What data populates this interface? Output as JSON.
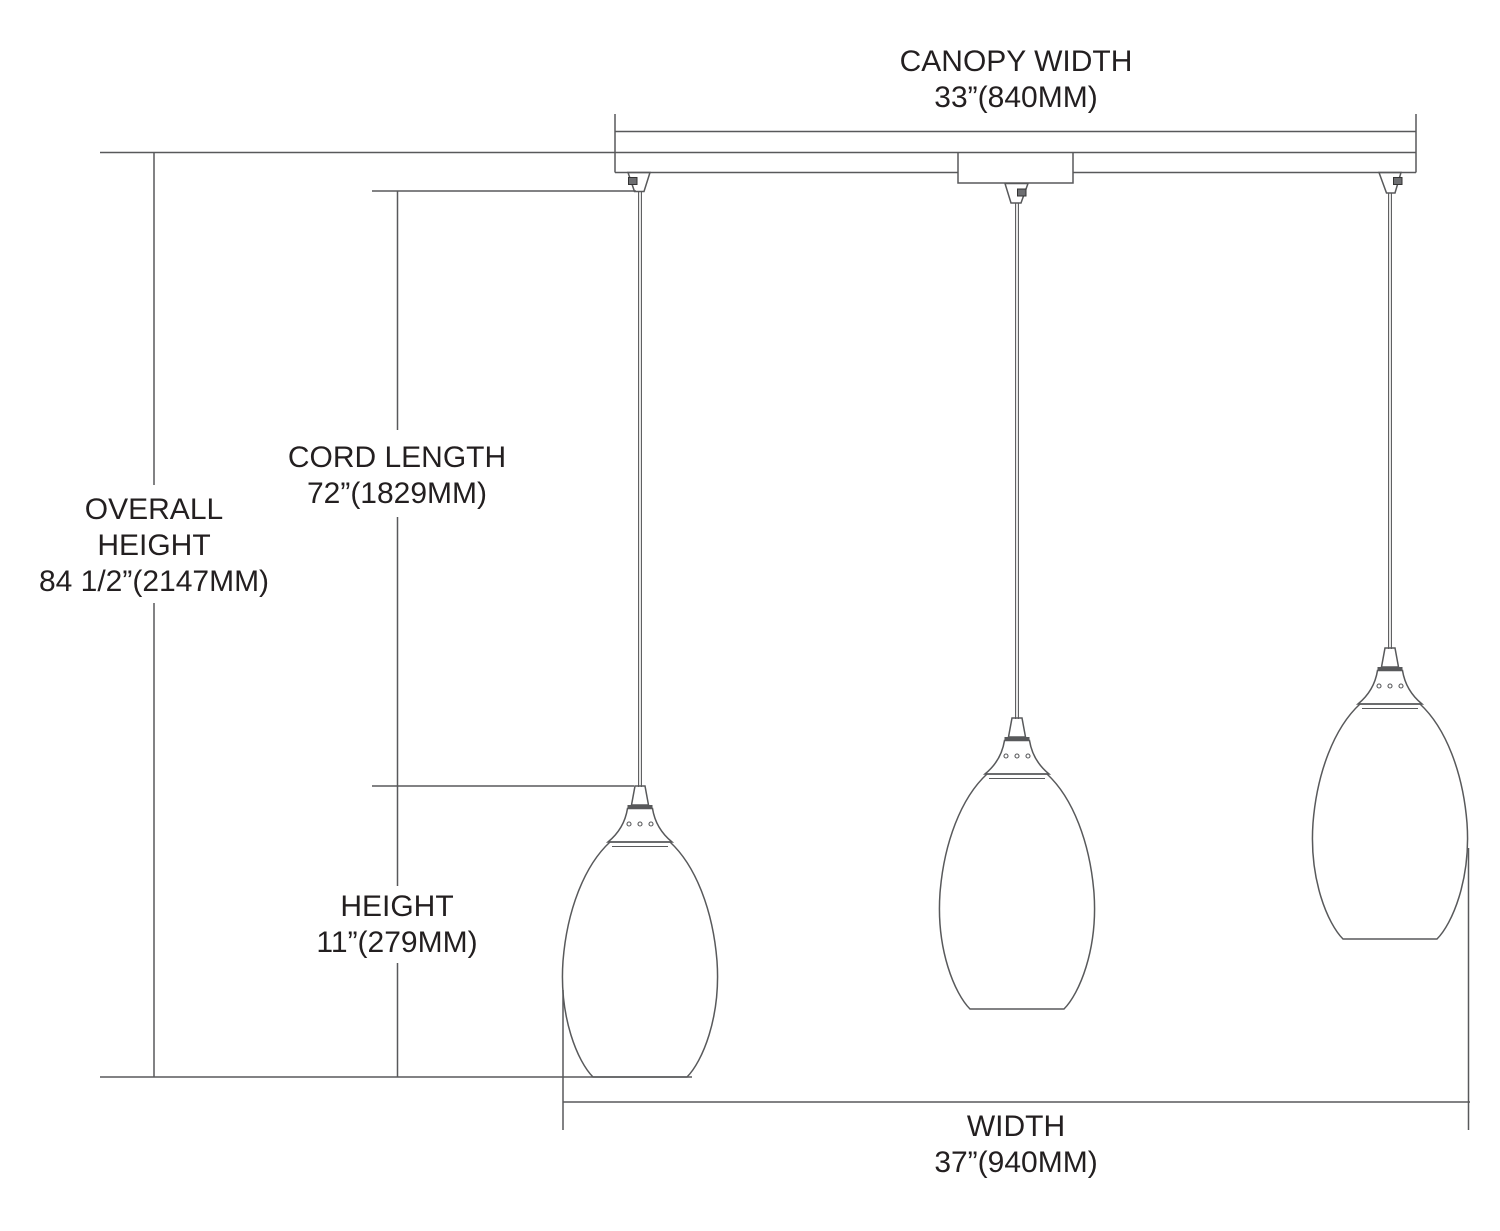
{
  "drawing": {
    "colors": {
      "line": "#58595b",
      "text": "#231f20",
      "background": "#ffffff"
    },
    "fixture": {
      "pendant_count": 3
    },
    "dimensions": {
      "canopy_width": {
        "name": "CANOPY WIDTH",
        "value": "33”(840MM)"
      },
      "overall_height": {
        "name_lines": [
          "OVERALL",
          "HEIGHT"
        ],
        "value": "84 1/2”(2147MM)"
      },
      "cord_length": {
        "name": "CORD LENGTH",
        "value": "72”(1829MM)"
      },
      "height": {
        "name": "HEIGHT",
        "value": "11”(279MM)"
      },
      "width": {
        "name": "WIDTH",
        "value": "37”(940MM)"
      }
    }
  }
}
